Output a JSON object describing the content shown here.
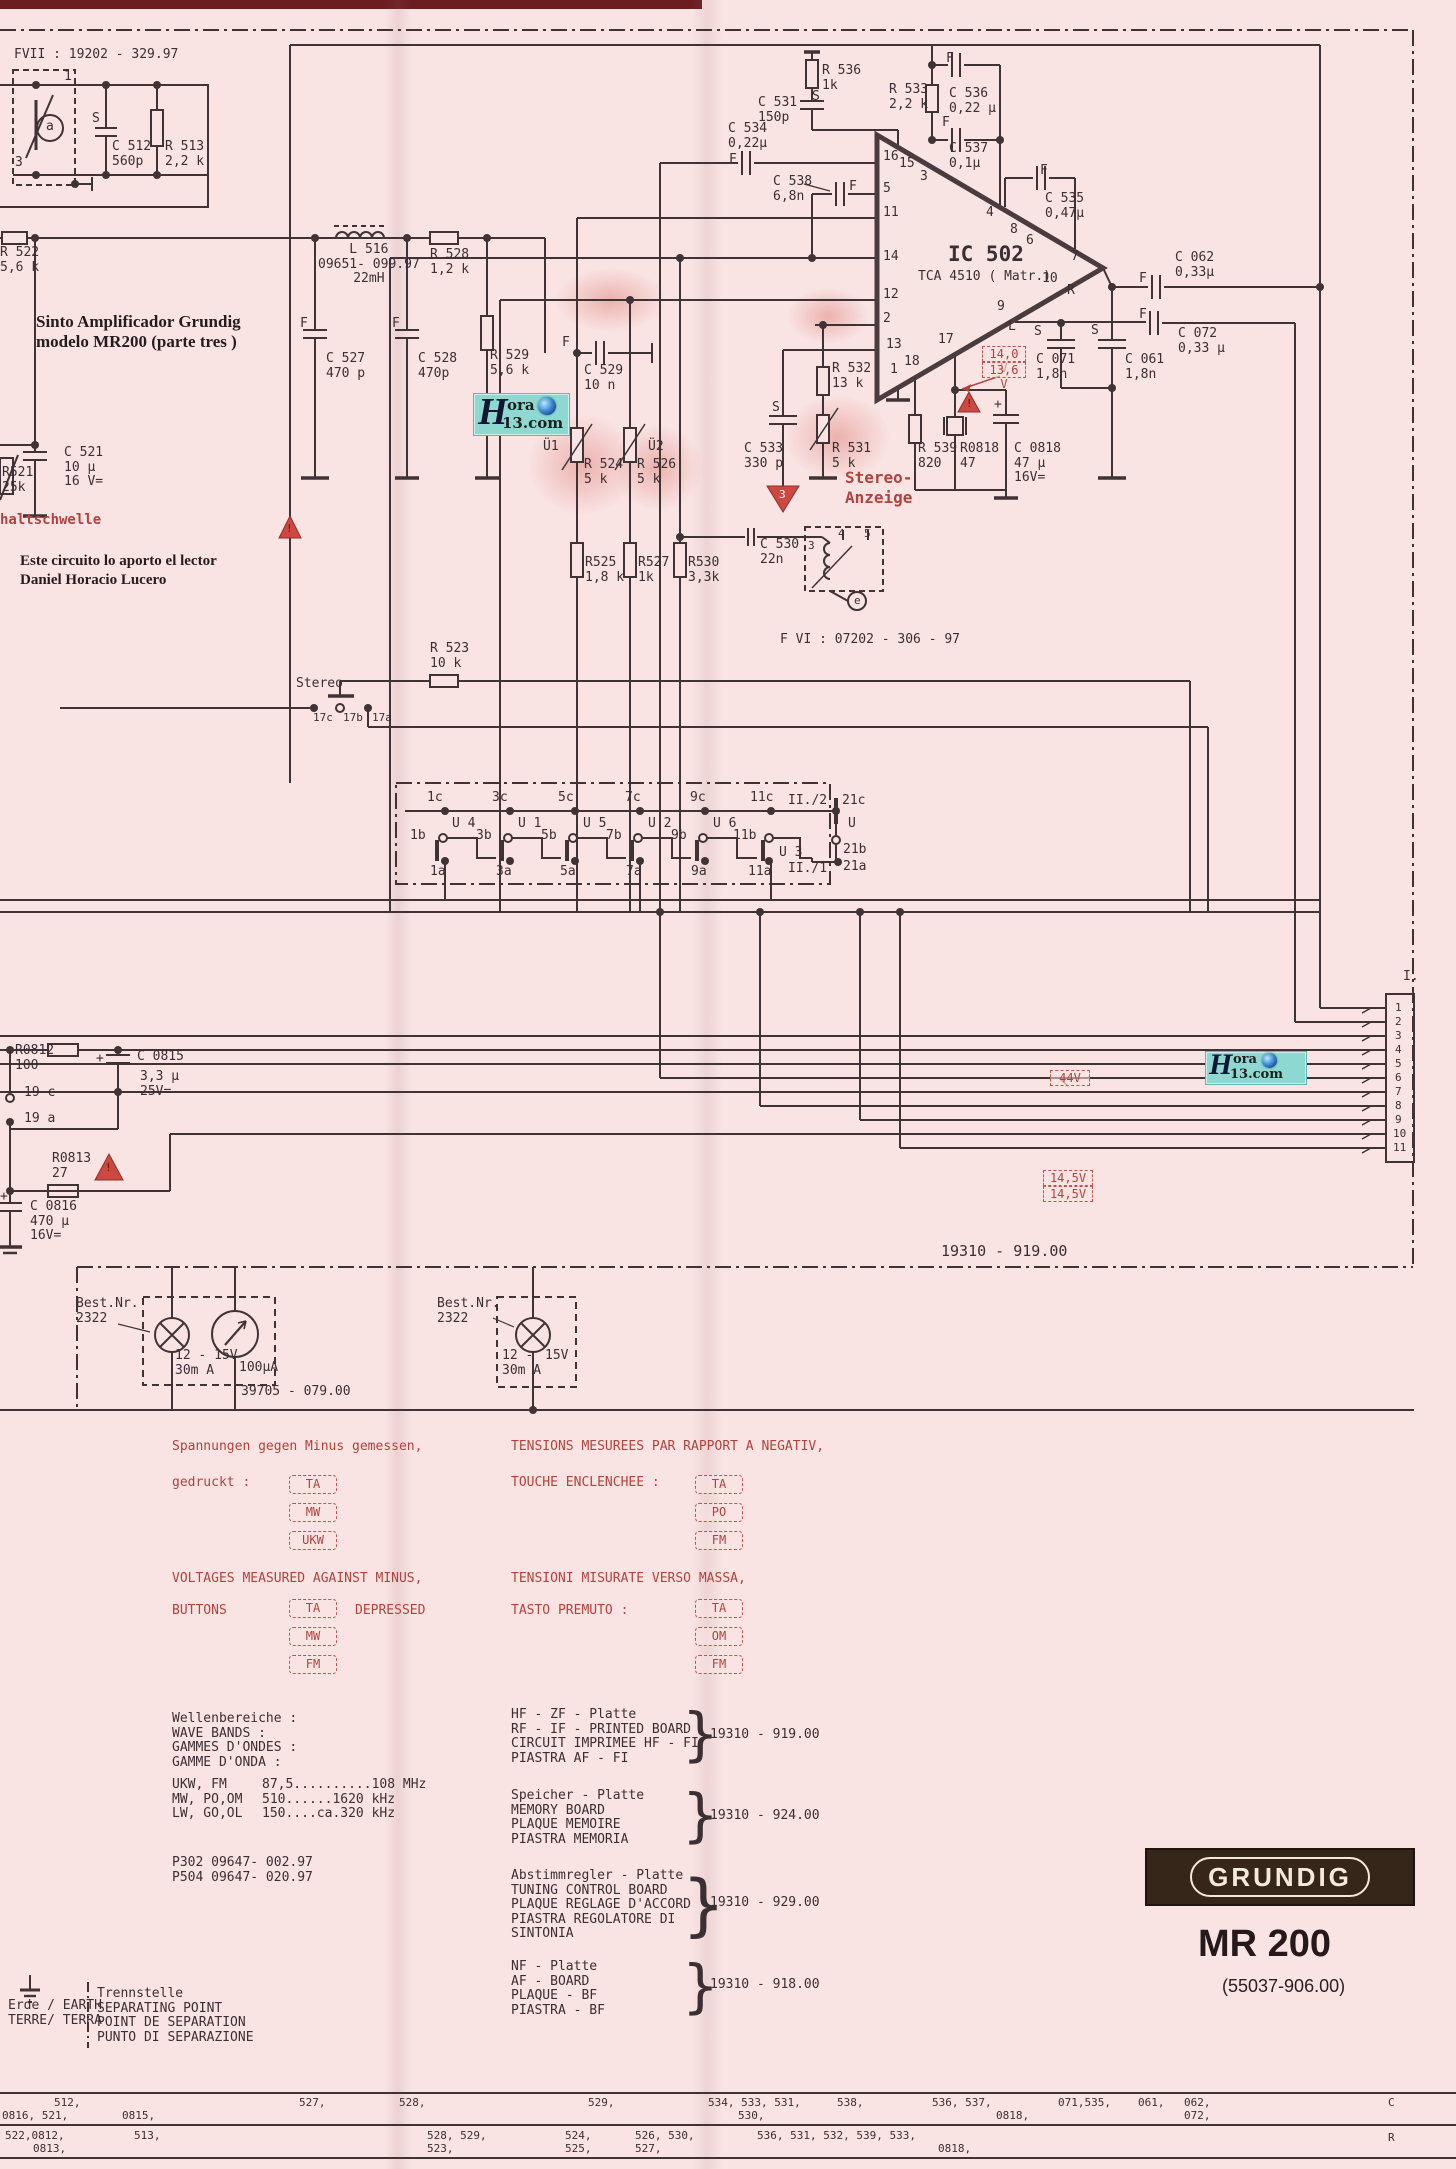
{
  "meta": {
    "brand": "GRUNDIG",
    "model": "MR 200",
    "part": "(55037-906.00)"
  },
  "colors": {
    "bg": "#f9e3e3",
    "line": "#3f3336",
    "red": "#b0433d",
    "logo_bg": "#362619"
  },
  "wm": {
    "h": "H",
    "ora": "ora",
    "site": "13.com"
  },
  "connector": {
    "title": "I.",
    "pins": [
      "1",
      "2",
      "3",
      "4",
      "5",
      "6",
      "7",
      "8",
      "9",
      "10",
      "11"
    ]
  },
  "buttons": {
    "ta": "TA",
    "mw": "MW",
    "ukw": "UKW",
    "po": "PO",
    "fm": "FM",
    "om": "OM"
  },
  "t": {
    "fvii": "FVII : 19202 - 329.97",
    "c512": "C 512\n560p",
    "r513": "R 513\n2,2 k",
    "k1": "1",
    "k3": "3",
    "s": "S",
    "f": "F",
    "ka": "a",
    "plus": "+",
    "r522": "R 522\n5,6 k",
    "l516": "L 516\n09651- 099.97\n22mH",
    "r528": "R 528\n1,2 k",
    "c527": "C 527\n470 p",
    "c528": "C 528\n470p",
    "r529": "R 529\n5,6 k",
    "sinto": "Sinto Amplificador Grundig\nmodelo MR200 (parte tres )",
    "c521": "C 521\n10 µ\n16 V=",
    "r521": "R521\n25k",
    "haltschwelle": "haltschwelle",
    "este": "Este circuito lo aporto el lector\nDaniel Horacio Lucero",
    "r536": "R 536\n1k",
    "c531": "C 531\n150p",
    "c534": "C 534\n0,22µ",
    "c538": "C 538\n6,8n",
    "r533": "R 533\n2,2 k",
    "c536": "C 536\n0,22 µ",
    "c537": "C 537\n0,1µ",
    "ic": "IC 502",
    "icsub": "TCA 4510 ( Matr.)",
    "p16": "16",
    "p15": "15",
    "p5": "5",
    "p11": "11",
    "p14": "14",
    "p12": "12",
    "p2": "2",
    "p13": "13",
    "p1": "1",
    "p18": "18",
    "p17": "17",
    "p3": "3",
    "p4": "4",
    "p8": "8",
    "p6": "6",
    "p9": "9",
    "p7": "7",
    "p10": "10",
    "pl": "L",
    "ps": "S",
    "pr": "R",
    "c529": "C 529\n10 n",
    "u1": "Ü1",
    "u2": "Ü2",
    "r524": "R 524\n5 k",
    "r526": "R 526\n5 k",
    "c533": "C 533\n330 p",
    "r531": "R 531\n5 k",
    "r532": "R 532\n13 k",
    "stereoanzeige": "Stereo-\nAnzeige",
    "r539": "R 539\n820",
    "r0818": "R0818\n47",
    "c0818": "C 0818\n47 µ\n16V=",
    "v140": "14,0 V",
    "v136": "13,6 V",
    "r525": "R525\n1,8 k",
    "r527": "R527\n1k",
    "r530": "R530\n3,3k",
    "c530": "C 530\n22n",
    "tr3": "3",
    "tr4": "4",
    "tr5": "5",
    "tre": "e",
    "fvi": "F VI : 07202 - 306 - 97",
    "r523": "R 523\n10 k",
    "stereo": "Stereo",
    "s17c": "17c",
    "s17b": "17b",
    "s17a": "17a",
    "a1c": "1c",
    "a3c": "3c",
    "a5c": "5c",
    "a7c": "7c",
    "a9c": "9c",
    "a11c": "11c",
    "ii2": "II./2",
    "a21c": "21c",
    "b1": "1b",
    "b3": "3b",
    "b5": "5b",
    "b7": "7b",
    "b9": "9b",
    "b11": "11b",
    "b21": "21b",
    "u4": "U 4",
    "uu1": "U 1",
    "u5": "U 5",
    "uu2": "U 2",
    "u6": "U 6",
    "u3": "U 3",
    "uu": "U",
    "c1a": "1a",
    "c3a": "3a",
    "c5a": "5a",
    "c7a": "7a",
    "c9a": "9a",
    "c11a": "11a",
    "ii1": "II./1",
    "a21a": "21a",
    "c062": "C 062\n0,33µ",
    "c072": "C 072\n0,33 µ",
    "c071": "C 071\n1,8n",
    "c061": "C 061\n1,8n",
    "c535": "C 535\n0,47µ",
    "r0812": "R0812\n100",
    "c0815": "C 0815",
    "c0815v": "3,3 µ\n25V=",
    "n19c": "19 c",
    "n19a": "19 a",
    "r0813": "R0813\n27",
    "c0816": "C 0816\n470 µ\n16V=",
    "v44": "44V",
    "v145": "14,5V",
    "n919": "19310 - 919.00",
    "bestnr": "Best.Nr.\n2322",
    "lamp1": "12 - 15V\n30m A",
    "ua": "100µA",
    "n39705": "39705 - 079.00",
    "lamp2a": "12 -\n30m A",
    "lamp2b": "15V",
    "spann": "Spannungen gegen Minus gemessen,",
    "gedruckt": "gedruckt :",
    "tensions": "TENSIONS MESUREES PAR RAPPORT A NEGATIV,",
    "touche": "TOUCHE ENCLENCHEE :",
    "voltages": "VOLTAGES MEASURED AGAINST MINUS,",
    "buttons_lbl": "BUTTONS",
    "depressed": "DEPRESSED",
    "tensioni": "TENSIONI MISURATE VERSO MASSA,",
    "tasto": "TASTO PREMUTO :",
    "wellen": "Wellenbereiche :\nWAVE BANDS :\nGAMMES D'ONDES :\nGAMME D'ONDA :",
    "bands": "UKW, FM\nMW, PO,OM\nLW, GO,OL",
    "freqs": "87,5..........108 MHz\n510......1620 kHz\n150....ca.320 kHz",
    "p302": "P302   09647- 002.97\nP504   09647- 020.97",
    "hfzf": "HF - ZF - Platte\nRF - IF - PRINTED BOARD\nCIRCUIT IMPRIMEE  HF - FI\nPIASTRA  AF - FI",
    "speicher": "Speicher - Platte\nMEMORY  BOARD\nPLAQUE  MEMOIRE\nPIASTRA  MEMORIA",
    "abstimm": "Abstimmregler - Platte\nTUNING  CONTROL  BOARD\nPLAQUE  REGLAGE  D'ACCORD\nPIASTRA  REGOLATORE  DI\nSINTONIA",
    "nf": "NF - Platte\nAF - BOARD\nPLAQUE - BF\nPIASTRA - BF",
    "n924": "19310 - 924.00",
    "n929": "19310 - 929.00",
    "n918": "19310 - 918.00",
    "trenn": "Trennstelle\nSEPARATING POINT\nPOINT DE SEPARATION\nPUNTO DI SEPARAZIONE",
    "erde": "Erde / EARTH\nTERRE/ TERRA",
    "brace": "}",
    "excl": "!",
    "tri3": "3",
    "r1a": "512,",
    "r1b": "0816, 521,",
    "r1c": "0815,",
    "r1d": "527,",
    "r1e": "528,",
    "r1f": "529,",
    "r1g": "534, 533, 531,",
    "r1h": "530,",
    "r1i": "538,",
    "r1j": "536, 537,",
    "r1k": "0818,",
    "r1l": "071,535,",
    "r1m": "061,",
    "r1n": "062,",
    "r1o": "072,",
    "rc": "C",
    "r2a": "522,0812,",
    "r2b": "0813,",
    "r2c": "513,",
    "r2d": "528,  529,",
    "r2e": "523,",
    "r2f": "524,",
    "r2g": "525,",
    "r2h": "526,  530,",
    "r2i": "527,",
    "r2j": "536, 531, 532,   539, 533,",
    "r2k": "0818,",
    "rr": "R"
  }
}
